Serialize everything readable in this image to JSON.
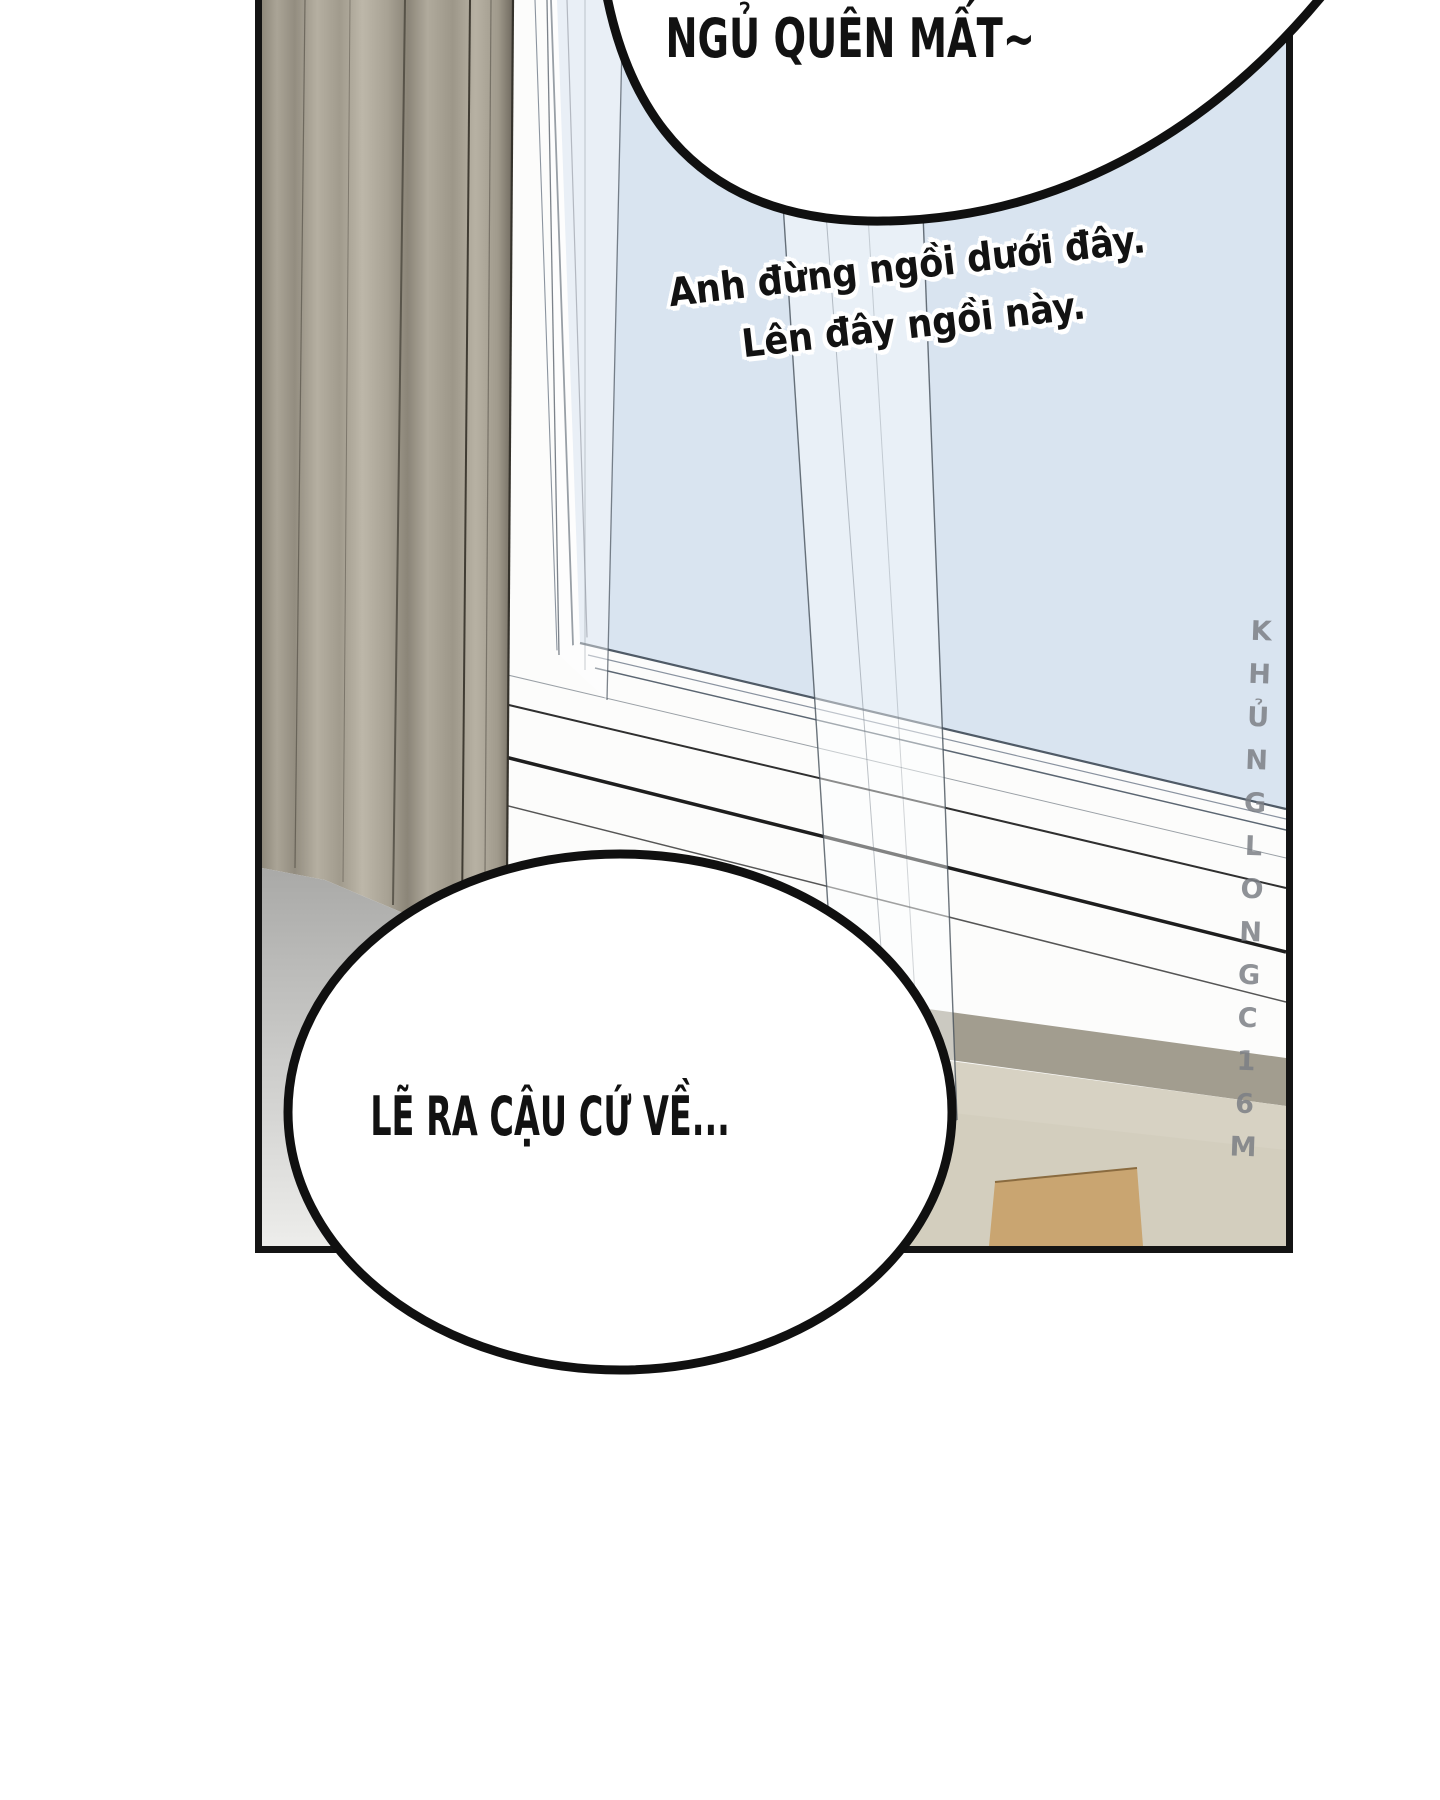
{
  "panel": {
    "border_color": "#141414"
  },
  "dialogue": {
    "top_bubble_text": "NGỦ QUÊN MẤT~",
    "floating_line1": "Anh đừng ngồi dưới đây.",
    "floating_line2": "Lên đây ngồi này.",
    "bottom_bubble_text": "LẼ RA CẬU CỨ VỀ..."
  },
  "watermark": {
    "text": "KHỦNGLONGC16M",
    "color": "#7b7f85"
  },
  "colors": {
    "glass": "#d9e4f0",
    "glass_light": "#e6eef7",
    "curtain": "#a8a294",
    "curtain_shadow": "#6f695e",
    "frame_white": "#fcfcfb",
    "wall": "#d7d2c3",
    "wall_shadow": "#a29d8f",
    "floor_top": "#a9a9a7",
    "floor_bottom": "#ededeb",
    "wood": "#c9a571",
    "bubble_fill": "#ffffff",
    "bubble_outline": "#101010",
    "text": "#121212"
  }
}
